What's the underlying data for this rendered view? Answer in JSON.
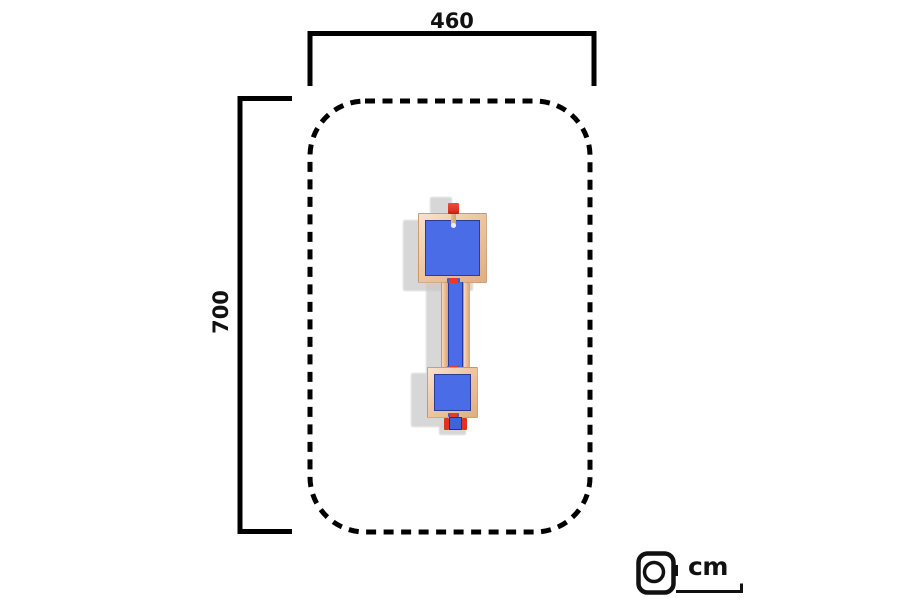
{
  "diagram": {
    "width_label": "460",
    "height_label": "700",
    "unit_label": "cm",
    "footprint": {
      "width_cm": 460,
      "depth_cm": 700,
      "unit": "cm"
    },
    "icons": {
      "unit_icon": "tape-measure-icon"
    },
    "colors": {
      "background": "#ffffff",
      "outline": "#000000",
      "floor_blue": "#4a6ce6",
      "floor_border": "#2b3c96",
      "wood_light": "#f7e3cd",
      "wood_dark": "#e0ae83",
      "accent_red": "#e63a2b",
      "shadow_gray": "#c9c9c9"
    }
  }
}
